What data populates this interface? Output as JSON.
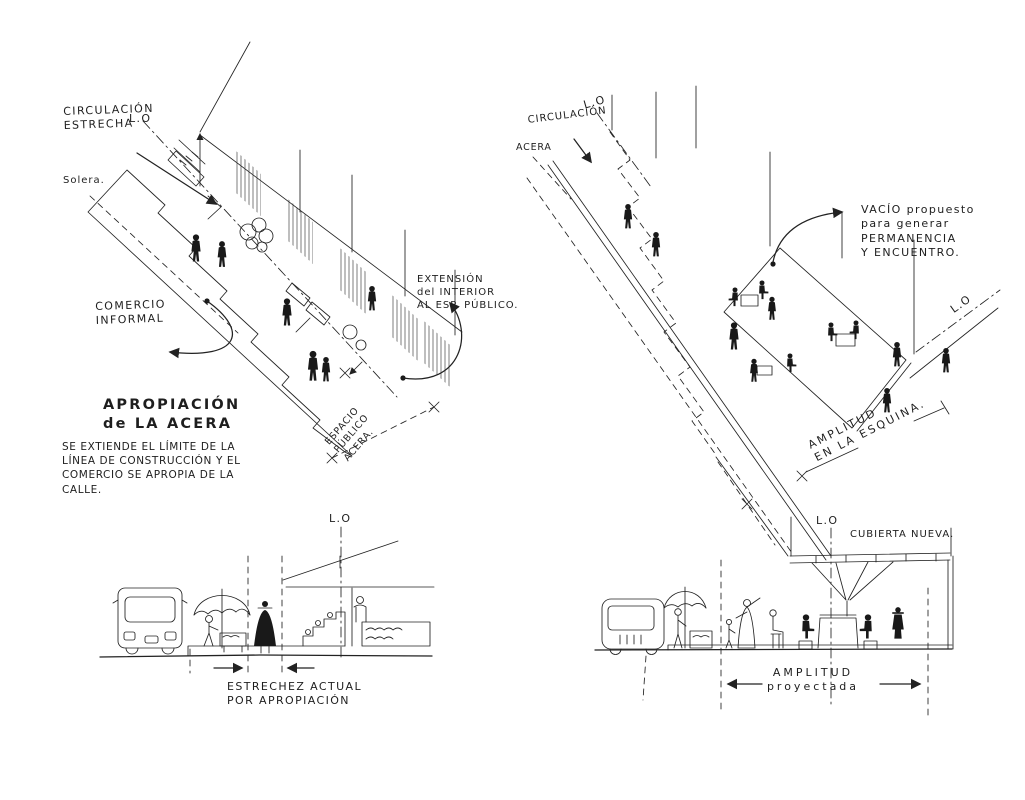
{
  "colors": {
    "ink": "#222222",
    "paper": "#ffffff"
  },
  "top_left": {
    "labels": {
      "circulacion_estrecha": "CIRCULACIÓN\nESTRECHA",
      "lo": "L.O",
      "solera": "Solera.",
      "comercio_informal": "COMERCIO\nINFORMAL",
      "extension_interior": "EXTENSIÓN\ndel INTERIOR\nAL ESP. PÚBLICO.",
      "espacio_publico_acera": "ESPACIO\nPÚBLICO\nACERA.",
      "apropiacion_titulo": "APROPIACIÓN\nde LA ACERA",
      "apropiacion_texto": "SE EXTIENDE EL LÍMITE DE LA\nLÍNEA DE CONSTRUCCIÓN Y EL\nCOMERCIO SE APROPIA DE LA\nCALLE."
    }
  },
  "top_right": {
    "labels": {
      "circulacion": "CIRCULACIÓN",
      "lo_top": "L.O",
      "acera": "ACERA",
      "vacio_propuesto": "VACÍO propuesto\npara generar\nPERMANENCIA\nY ENCUENTRO.",
      "lo_derecha": "L.O",
      "amplitud_esquina": "AMPLITUD\nEN LA ESQUINA."
    }
  },
  "bottom_left": {
    "labels": {
      "lo": "L.O",
      "estrechez_actual": "ESTRECHEZ ACTUAL\nPOR APROPIACIÓN"
    }
  },
  "bottom_right": {
    "labels": {
      "lo": "L.O",
      "cubierta_nueva": "CUBIERTA NUEVA.",
      "amplitud_proyectada": "AMPLITUD\nproyectada"
    }
  }
}
